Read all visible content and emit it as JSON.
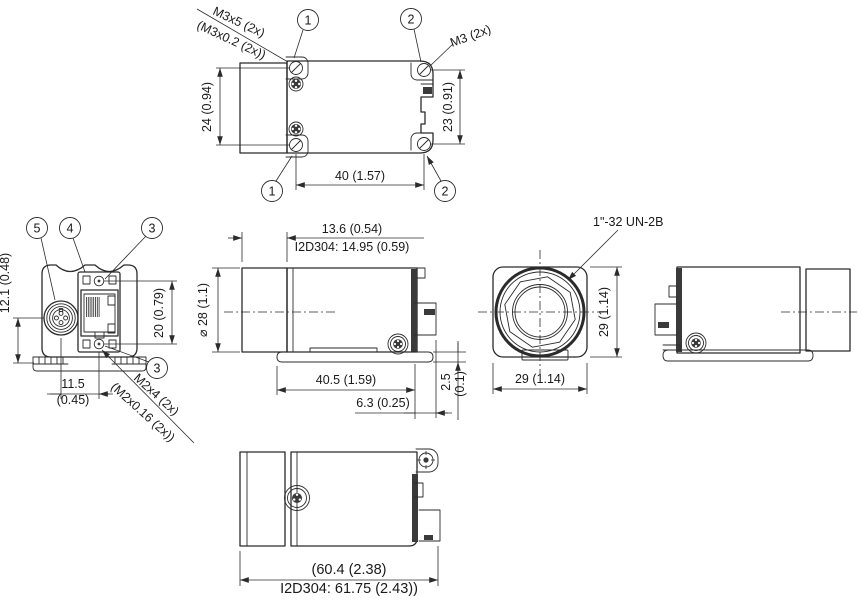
{
  "drawing": {
    "callouts": {
      "n1": "1",
      "n2": "2",
      "n3": "3",
      "n4": "4",
      "n5": "5"
    },
    "top_view": {
      "thread_label_line1": "M3x5 (2x)",
      "thread_label_line2": "(M3x0.2 (2x))",
      "thread_label_right": "M3 (2x)",
      "dim_height_left": "24 (0.94)",
      "dim_height_right": "23 (0.91)",
      "dim_width": "40 (1.57)"
    },
    "rear_view": {
      "dim_connector_offset": "12.1 (0.48)",
      "dim_port_height": "20 (0.79)",
      "dim_spacing": "11.5",
      "dim_spacing_inch": "(0.45)",
      "screw_label_line1": "M2x4 (2x)",
      "screw_label_line2": "(M2x0.16 (2x))"
    },
    "side_view": {
      "dim_front_len": "13.6 (0.54)",
      "dim_front_len_alt": "I2D304: 14.95 (0.59)",
      "dim_diameter": "⌀ 28 (1.1)",
      "dim_body_len": "40.5 (1.59)",
      "dim_rear_len": "6.3 (0.25)",
      "dim_plate": "2.5",
      "dim_plate_inch": "(0.1)"
    },
    "front_view": {
      "thread_label": "1\"-32 UN-2B",
      "dim_height": "29 (1.14)",
      "dim_width": "29 (1.14)"
    },
    "bottom_view": {
      "dim_total_len": "(60.4 (2.38)",
      "dim_total_len_alt": "I2D304: 61.75 (2.43))"
    }
  }
}
